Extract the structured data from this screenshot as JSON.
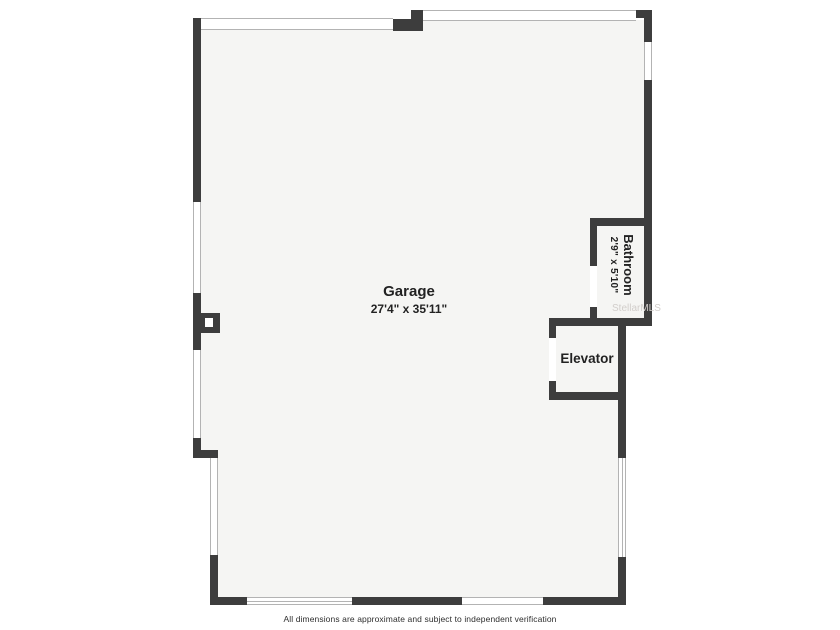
{
  "floorplan": {
    "rooms": {
      "garage": {
        "name": "Garage",
        "dimensions": "27'4\" x 35'11\""
      },
      "bathroom": {
        "name": "Bathroom",
        "dimensions": "2'9\" x 5'10\""
      },
      "elevator": {
        "name": "Elevator"
      }
    },
    "watermark": "StellarMLS",
    "disclaimer": "All dimensions are approximate and subject to independent verification",
    "colors": {
      "wall": "#3d3d3d",
      "room_fill": "#f5f5f3",
      "window_line": "#b3b3b3",
      "label_text": "#222222",
      "watermark_text": "#d2cecb",
      "background": "#ffffff"
    }
  }
}
